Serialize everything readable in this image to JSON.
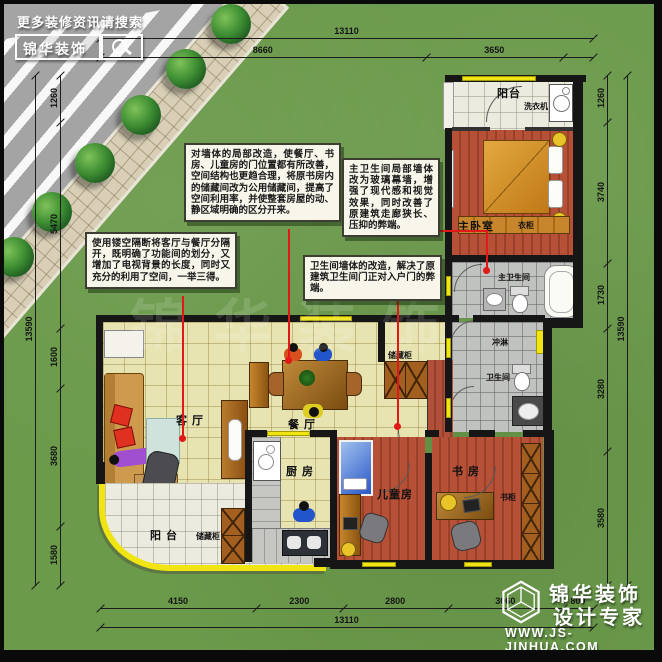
{
  "header": {
    "tagline": "更多装修资讯请搜索",
    "brand": "锦华装饰"
  },
  "annotations": {
    "box1": "对墙体的局部改造，使餐厅、书房、儿童房的门位置都有所改善，空间结构也更趋合理，将原书房内的储藏间改为公用储藏间，提高了空间利用率，并使整套房屋的动、静区域明确的区分开来。",
    "box2": "使用镂空隔断将客厅与餐厅分隔开，既明确了功能间的划分，又增加了电视背景的长度，同时又充分的利用了空间，一举三得。",
    "box3": "主卫生间局部墙体改为玻璃幕墙，增强了现代感和视觉效果，同时改善了原建筑走廊狭长、压抑的弊端。",
    "box4": "卫生间墙体的改造，解决了原建筑卫生间门正对入户门的弊端。"
  },
  "rooms": {
    "balcony_top": "阳台",
    "washer": "洗衣机",
    "master_bedroom": "主卧室",
    "wardrobe": "衣柜",
    "master_bath": "主卫生间",
    "shower": "冲淋",
    "bath": "卫生间",
    "storage_hall": "储藏柜",
    "dining": "餐 厅",
    "living": "客 厅",
    "kitchen": "厨 房",
    "balcony_bottom": "阳 台",
    "storage_balcony": "储藏柜",
    "kids": "儿童房",
    "study": "书 房",
    "bookcase": "书柜"
  },
  "dimensions": {
    "top_total": "13110",
    "top_segments": [
      "8660",
      "3650"
    ],
    "bottom_segments": [
      "4150",
      "2300",
      "2800",
      "3060",
      "800"
    ],
    "bottom_total": "13110",
    "left_segments": [
      "1260",
      "5470",
      "1600",
      "3680",
      "1580"
    ],
    "left_total": "13590",
    "right_segments": [
      "1260",
      "3740",
      "1730",
      "3280",
      "3580"
    ],
    "right_total": "13590"
  },
  "footer": {
    "brand_line1": "锦华装饰",
    "brand_line2": "设计专家",
    "url": "WWW.JS-JINHUA.COM"
  },
  "colors": {
    "grass": "#6b9a4b",
    "wall": "#161616",
    "leader_red": "#e01818",
    "window_yellow": "#f0e412",
    "floor_cream": "#e8e4b2",
    "floor_terracotta": "#b65138",
    "floor_gray": "#c0c2bf"
  }
}
